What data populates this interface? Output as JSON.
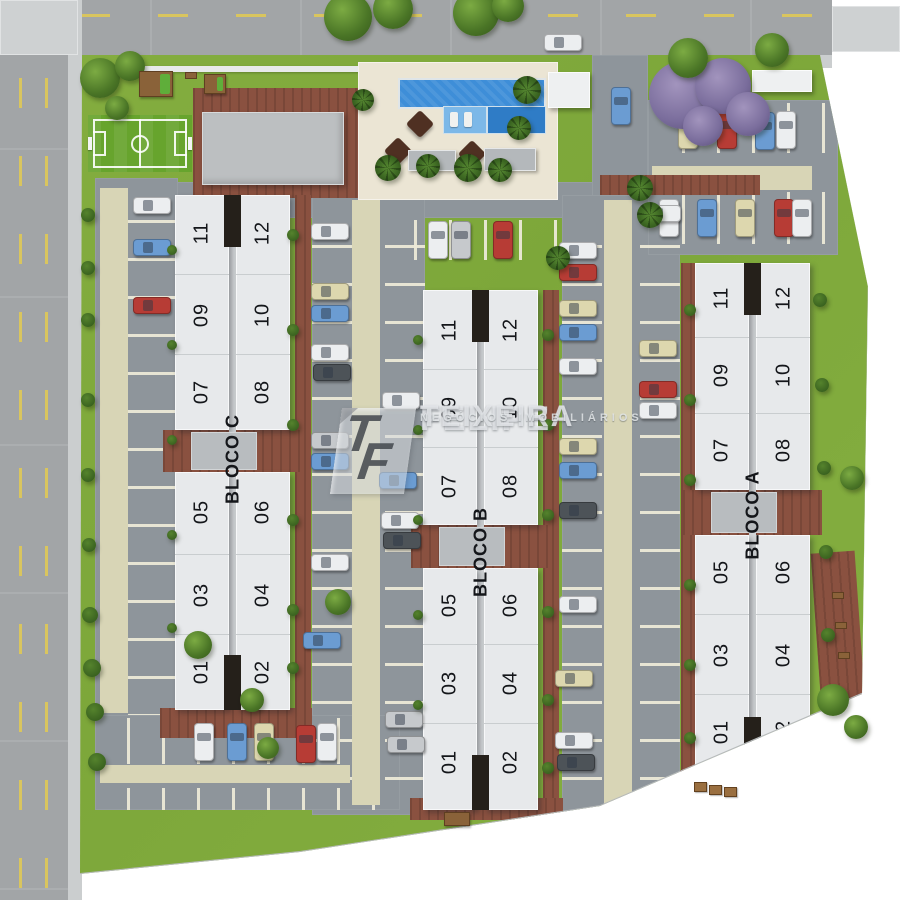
{
  "watermark": {
    "monogram_t": "T",
    "monogram_f": "F",
    "line1": "FELIPE",
    "registered": "®",
    "line2": "TEIXEIRA",
    "line3": "NEGÓCIOS IMOBILIÁRIOS"
  },
  "colors": {
    "grass": "#82ac3e",
    "road": "#a2a5a7",
    "sidewalk": "#cbcecf",
    "asphalt": "#8e959b",
    "walkway_beige": "#d8d5b6",
    "stall_line": "#ece9d6",
    "brick": "#8a5140",
    "building_slab": "#e7e9eb",
    "building_gap": "#25201a",
    "entry_plaza": "#b8bcbf",
    "pool": "#3e8ed8",
    "pool_shelf": "#7cb8e8",
    "pool_deep": "#2f7cc6",
    "pool_deck": "#ebe5d4",
    "soccer_field": "#67a42d",
    "road_marking_yellow": "#d9c55e",
    "umbrella_brown": "#4f3022",
    "cars": {
      "white": "#eceef0",
      "cream": "#ddd7ae",
      "blue": "#6b9cd2",
      "red": "#b73c35",
      "dark": "#4d5358",
      "silver": "#c6c9cc"
    }
  },
  "blocks": [
    {
      "id": "c",
      "label": "BLOCO C",
      "label_y": 459,
      "x": 175,
      "top": 195,
      "bottom": 710,
      "entry_top": 430,
      "entry_bottom": 472,
      "left_cx": 202,
      "right_cx": 263,
      "left_units": [
        {
          "n": "11",
          "y": 233
        },
        {
          "n": "09",
          "y": 315
        },
        {
          "n": "07",
          "y": 392
        },
        {
          "n": "05",
          "y": 512
        },
        {
          "n": "03",
          "y": 595
        },
        {
          "n": "01",
          "y": 672
        }
      ],
      "right_units": [
        {
          "n": "12",
          "y": 233
        },
        {
          "n": "10",
          "y": 315
        },
        {
          "n": "08",
          "y": 392
        },
        {
          "n": "06",
          "y": 512
        },
        {
          "n": "04",
          "y": 595
        },
        {
          "n": "02",
          "y": 672
        }
      ]
    },
    {
      "id": "b",
      "label": "BLOCO B",
      "label_y": 552,
      "x": 423,
      "top": 290,
      "bottom": 810,
      "entry_top": 525,
      "entry_bottom": 568,
      "left_cx": 450,
      "right_cx": 511,
      "left_units": [
        {
          "n": "11",
          "y": 330
        },
        {
          "n": "09",
          "y": 408
        },
        {
          "n": "07",
          "y": 486
        },
        {
          "n": "05",
          "y": 605
        },
        {
          "n": "03",
          "y": 683
        },
        {
          "n": "01",
          "y": 762
        }
      ],
      "right_units": [
        {
          "n": "12",
          "y": 330
        },
        {
          "n": "10",
          "y": 408
        },
        {
          "n": "08",
          "y": 486
        },
        {
          "n": "06",
          "y": 605
        },
        {
          "n": "04",
          "y": 683
        },
        {
          "n": "02",
          "y": 762
        }
      ]
    },
    {
      "id": "a",
      "label": "BLOCO A",
      "label_y": 515,
      "x": 695,
      "top": 263,
      "bottom": 772,
      "entry_top": 490,
      "entry_bottom": 535,
      "left_cx": 722,
      "right_cx": 784,
      "left_units": [
        {
          "n": "11",
          "y": 298
        },
        {
          "n": "09",
          "y": 375
        },
        {
          "n": "07",
          "y": 450
        },
        {
          "n": "05",
          "y": 572
        },
        {
          "n": "03",
          "y": 655
        },
        {
          "n": "01",
          "y": 732
        }
      ],
      "right_units": [
        {
          "n": "12",
          "y": 298
        },
        {
          "n": "10",
          "y": 375
        },
        {
          "n": "08",
          "y": 450
        },
        {
          "n": "06",
          "y": 572
        },
        {
          "n": "04",
          "y": 655
        },
        {
          "n": "02",
          "y": 732
        }
      ]
    }
  ],
  "cars": [
    {
      "c": "white",
      "d": "h",
      "x": 563,
      "y": 42
    },
    {
      "c": "blue",
      "d": "v",
      "x": 621,
      "y": 106
    },
    {
      "c": "cream",
      "d": "v",
      "x": 688,
      "y": 130
    },
    {
      "c": "red",
      "d": "v",
      "x": 727,
      "y": 130
    },
    {
      "c": "blue",
      "d": "v",
      "x": 765,
      "y": 131
    },
    {
      "c": "white",
      "d": "v",
      "x": 786,
      "y": 130
    },
    {
      "c": "white",
      "d": "v",
      "x": 669,
      "y": 218
    },
    {
      "c": "blue",
      "d": "v",
      "x": 707,
      "y": 218
    },
    {
      "c": "cream",
      "d": "v",
      "x": 745,
      "y": 218
    },
    {
      "c": "red",
      "d": "v",
      "x": 784,
      "y": 218
    },
    {
      "c": "white",
      "d": "v",
      "x": 802,
      "y": 218
    },
    {
      "c": "white",
      "d": "v",
      "x": 438,
      "y": 240
    },
    {
      "c": "silver",
      "d": "v",
      "x": 461,
      "y": 240
    },
    {
      "c": "red",
      "d": "v",
      "x": 503,
      "y": 240
    },
    {
      "c": "white",
      "d": "h",
      "x": 152,
      "y": 205
    },
    {
      "c": "blue",
      "d": "h",
      "x": 152,
      "y": 247
    },
    {
      "c": "red",
      "d": "h",
      "x": 152,
      "y": 305
    },
    {
      "c": "white",
      "d": "h",
      "x": 330,
      "y": 231
    },
    {
      "c": "cream",
      "d": "h",
      "x": 330,
      "y": 291
    },
    {
      "c": "blue",
      "d": "h",
      "x": 330,
      "y": 313
    },
    {
      "c": "white",
      "d": "h",
      "x": 330,
      "y": 352
    },
    {
      "c": "dark",
      "d": "h",
      "x": 332,
      "y": 372
    },
    {
      "c": "silver",
      "d": "h",
      "x": 330,
      "y": 440
    },
    {
      "c": "blue",
      "d": "h",
      "x": 330,
      "y": 461
    },
    {
      "c": "white",
      "d": "h",
      "x": 330,
      "y": 562
    },
    {
      "c": "blue",
      "d": "h",
      "x": 322,
      "y": 640
    },
    {
      "c": "white",
      "d": "h",
      "x": 401,
      "y": 400
    },
    {
      "c": "blue",
      "d": "h",
      "x": 398,
      "y": 480
    },
    {
      "c": "white",
      "d": "h",
      "x": 400,
      "y": 520
    },
    {
      "c": "dark",
      "d": "h",
      "x": 402,
      "y": 540
    },
    {
      "c": "silver",
      "d": "h",
      "x": 404,
      "y": 719
    },
    {
      "c": "silver",
      "d": "h",
      "x": 406,
      "y": 744
    },
    {
      "c": "white",
      "d": "h",
      "x": 578,
      "y": 250
    },
    {
      "c": "red",
      "d": "h",
      "x": 578,
      "y": 272
    },
    {
      "c": "cream",
      "d": "h",
      "x": 578,
      "y": 308
    },
    {
      "c": "blue",
      "d": "h",
      "x": 578,
      "y": 332
    },
    {
      "c": "white",
      "d": "h",
      "x": 578,
      "y": 366
    },
    {
      "c": "cream",
      "d": "h",
      "x": 578,
      "y": 446
    },
    {
      "c": "blue",
      "d": "h",
      "x": 578,
      "y": 470
    },
    {
      "c": "dark",
      "d": "h",
      "x": 578,
      "y": 510
    },
    {
      "c": "white",
      "d": "h",
      "x": 578,
      "y": 604
    },
    {
      "c": "cream",
      "d": "h",
      "x": 574,
      "y": 678
    },
    {
      "c": "white",
      "d": "h",
      "x": 574,
      "y": 740
    },
    {
      "c": "dark",
      "d": "h",
      "x": 576,
      "y": 762
    },
    {
      "c": "white",
      "d": "h",
      "x": 662,
      "y": 213
    },
    {
      "c": "cream",
      "d": "h",
      "x": 658,
      "y": 348
    },
    {
      "c": "red",
      "d": "h",
      "x": 658,
      "y": 389
    },
    {
      "c": "white",
      "d": "h",
      "x": 658,
      "y": 410
    },
    {
      "c": "white",
      "d": "v",
      "x": 204,
      "y": 742
    },
    {
      "c": "blue",
      "d": "v",
      "x": 237,
      "y": 742
    },
    {
      "c": "cream",
      "d": "v",
      "x": 264,
      "y": 742
    },
    {
      "c": "red",
      "d": "v",
      "x": 306,
      "y": 744
    },
    {
      "c": "white",
      "d": "v",
      "x": 327,
      "y": 742
    }
  ],
  "trees": [
    {
      "t": "purple",
      "x": 683,
      "y": 95,
      "r": 34
    },
    {
      "t": "purple",
      "x": 723,
      "y": 86,
      "r": 28
    },
    {
      "t": "purple",
      "x": 748,
      "y": 114,
      "r": 22
    },
    {
      "t": "purple",
      "x": 703,
      "y": 126,
      "r": 20
    },
    {
      "t": "green",
      "x": 100,
      "y": 78,
      "r": 20
    },
    {
      "t": "green",
      "x": 130,
      "y": 66,
      "r": 15
    },
    {
      "t": "green",
      "x": 117,
      "y": 108,
      "r": 12
    },
    {
      "t": "green",
      "x": 348,
      "y": 17,
      "r": 24
    },
    {
      "t": "green",
      "x": 393,
      "y": 9,
      "r": 20
    },
    {
      "t": "green",
      "x": 476,
      "y": 13,
      "r": 23
    },
    {
      "t": "green",
      "x": 508,
      "y": 6,
      "r": 16
    },
    {
      "t": "green",
      "x": 688,
      "y": 58,
      "r": 20
    },
    {
      "t": "green",
      "x": 772,
      "y": 50,
      "r": 17
    },
    {
      "t": "green",
      "x": 198,
      "y": 645,
      "r": 14
    },
    {
      "t": "green",
      "x": 338,
      "y": 602,
      "r": 13
    },
    {
      "t": "green",
      "x": 252,
      "y": 700,
      "r": 12
    },
    {
      "t": "green",
      "x": 268,
      "y": 748,
      "r": 11
    },
    {
      "t": "green",
      "x": 852,
      "y": 478,
      "r": 12
    },
    {
      "t": "green",
      "x": 833,
      "y": 700,
      "r": 16
    },
    {
      "t": "green",
      "x": 856,
      "y": 727,
      "r": 12
    },
    {
      "t": "palm",
      "x": 527,
      "y": 90,
      "r": 14
    },
    {
      "t": "palm",
      "x": 519,
      "y": 128,
      "r": 12
    },
    {
      "t": "palm",
      "x": 388,
      "y": 168,
      "r": 13
    },
    {
      "t": "palm",
      "x": 428,
      "y": 166,
      "r": 12
    },
    {
      "t": "palm",
      "x": 468,
      "y": 168,
      "r": 14
    },
    {
      "t": "palm",
      "x": 500,
      "y": 170,
      "r": 12
    },
    {
      "t": "palm",
      "x": 363,
      "y": 100,
      "r": 11
    },
    {
      "t": "palm",
      "x": 640,
      "y": 188,
      "r": 13
    },
    {
      "t": "palm",
      "x": 558,
      "y": 258,
      "r": 12
    },
    {
      "t": "palm",
      "x": 650,
      "y": 215,
      "r": 13
    },
    {
      "t": "bush",
      "x": 88,
      "y": 215,
      "r": 7
    },
    {
      "t": "bush",
      "x": 88,
      "y": 268,
      "r": 7
    },
    {
      "t": "bush",
      "x": 88,
      "y": 320,
      "r": 7
    },
    {
      "t": "bush",
      "x": 88,
      "y": 400,
      "r": 7
    },
    {
      "t": "bush",
      "x": 88,
      "y": 475,
      "r": 7
    },
    {
      "t": "bush",
      "x": 89,
      "y": 545,
      "r": 7
    },
    {
      "t": "bush",
      "x": 90,
      "y": 615,
      "r": 8
    },
    {
      "t": "bush",
      "x": 92,
      "y": 668,
      "r": 9
    },
    {
      "t": "bush",
      "x": 95,
      "y": 712,
      "r": 9
    },
    {
      "t": "bush",
      "x": 97,
      "y": 762,
      "r": 9
    },
    {
      "t": "bush",
      "x": 293,
      "y": 235,
      "r": 6
    },
    {
      "t": "bush",
      "x": 293,
      "y": 330,
      "r": 6
    },
    {
      "t": "bush",
      "x": 293,
      "y": 425,
      "r": 6
    },
    {
      "t": "bush",
      "x": 293,
      "y": 520,
      "r": 6
    },
    {
      "t": "bush",
      "x": 293,
      "y": 610,
      "r": 6
    },
    {
      "t": "bush",
      "x": 293,
      "y": 668,
      "r": 6
    },
    {
      "t": "bush",
      "x": 172,
      "y": 250,
      "r": 5
    },
    {
      "t": "bush",
      "x": 172,
      "y": 345,
      "r": 5
    },
    {
      "t": "bush",
      "x": 172,
      "y": 440,
      "r": 5
    },
    {
      "t": "bush",
      "x": 172,
      "y": 535,
      "r": 5
    },
    {
      "t": "bush",
      "x": 172,
      "y": 628,
      "r": 5
    },
    {
      "t": "bush",
      "x": 418,
      "y": 340,
      "r": 5
    },
    {
      "t": "bush",
      "x": 418,
      "y": 430,
      "r": 5
    },
    {
      "t": "bush",
      "x": 418,
      "y": 520,
      "r": 5
    },
    {
      "t": "bush",
      "x": 418,
      "y": 615,
      "r": 5
    },
    {
      "t": "bush",
      "x": 418,
      "y": 705,
      "r": 5
    },
    {
      "t": "bush",
      "x": 548,
      "y": 335,
      "r": 6
    },
    {
      "t": "bush",
      "x": 548,
      "y": 425,
      "r": 6
    },
    {
      "t": "bush",
      "x": 548,
      "y": 515,
      "r": 6
    },
    {
      "t": "bush",
      "x": 548,
      "y": 612,
      "r": 6
    },
    {
      "t": "bush",
      "x": 548,
      "y": 700,
      "r": 6
    },
    {
      "t": "bush",
      "x": 548,
      "y": 768,
      "r": 6
    },
    {
      "t": "bush",
      "x": 690,
      "y": 310,
      "r": 6
    },
    {
      "t": "bush",
      "x": 690,
      "y": 400,
      "r": 6
    },
    {
      "t": "bush",
      "x": 690,
      "y": 480,
      "r": 6
    },
    {
      "t": "bush",
      "x": 690,
      "y": 585,
      "r": 6
    },
    {
      "t": "bush",
      "x": 690,
      "y": 665,
      "r": 6
    },
    {
      "t": "bush",
      "x": 690,
      "y": 738,
      "r": 6
    },
    {
      "t": "bush",
      "x": 820,
      "y": 300,
      "r": 7
    },
    {
      "t": "bush",
      "x": 822,
      "y": 385,
      "r": 7
    },
    {
      "t": "bush",
      "x": 824,
      "y": 468,
      "r": 7
    },
    {
      "t": "bush",
      "x": 826,
      "y": 552,
      "r": 7
    },
    {
      "t": "bush",
      "x": 828,
      "y": 635,
      "r": 7
    }
  ],
  "props": [
    {
      "t": "bench",
      "x": 840,
      "y": 598
    },
    {
      "t": "bench",
      "x": 843,
      "y": 628
    },
    {
      "t": "bench",
      "x": 846,
      "y": 658
    },
    {
      "t": "table",
      "x": 702,
      "y": 788
    },
    {
      "t": "table",
      "x": 717,
      "y": 791
    },
    {
      "t": "table",
      "x": 732,
      "y": 793
    },
    {
      "t": "pergola",
      "x": 452,
      "y": 818
    },
    {
      "t": "playset",
      "x": 147,
      "y": 77,
      "w": 34,
      "h": 26
    },
    {
      "t": "bench",
      "x": 193,
      "y": 78
    },
    {
      "t": "playset",
      "x": 212,
      "y": 80,
      "w": 22,
      "h": 20
    },
    {
      "t": "pavers",
      "x": 263,
      "y": 86
    }
  ]
}
